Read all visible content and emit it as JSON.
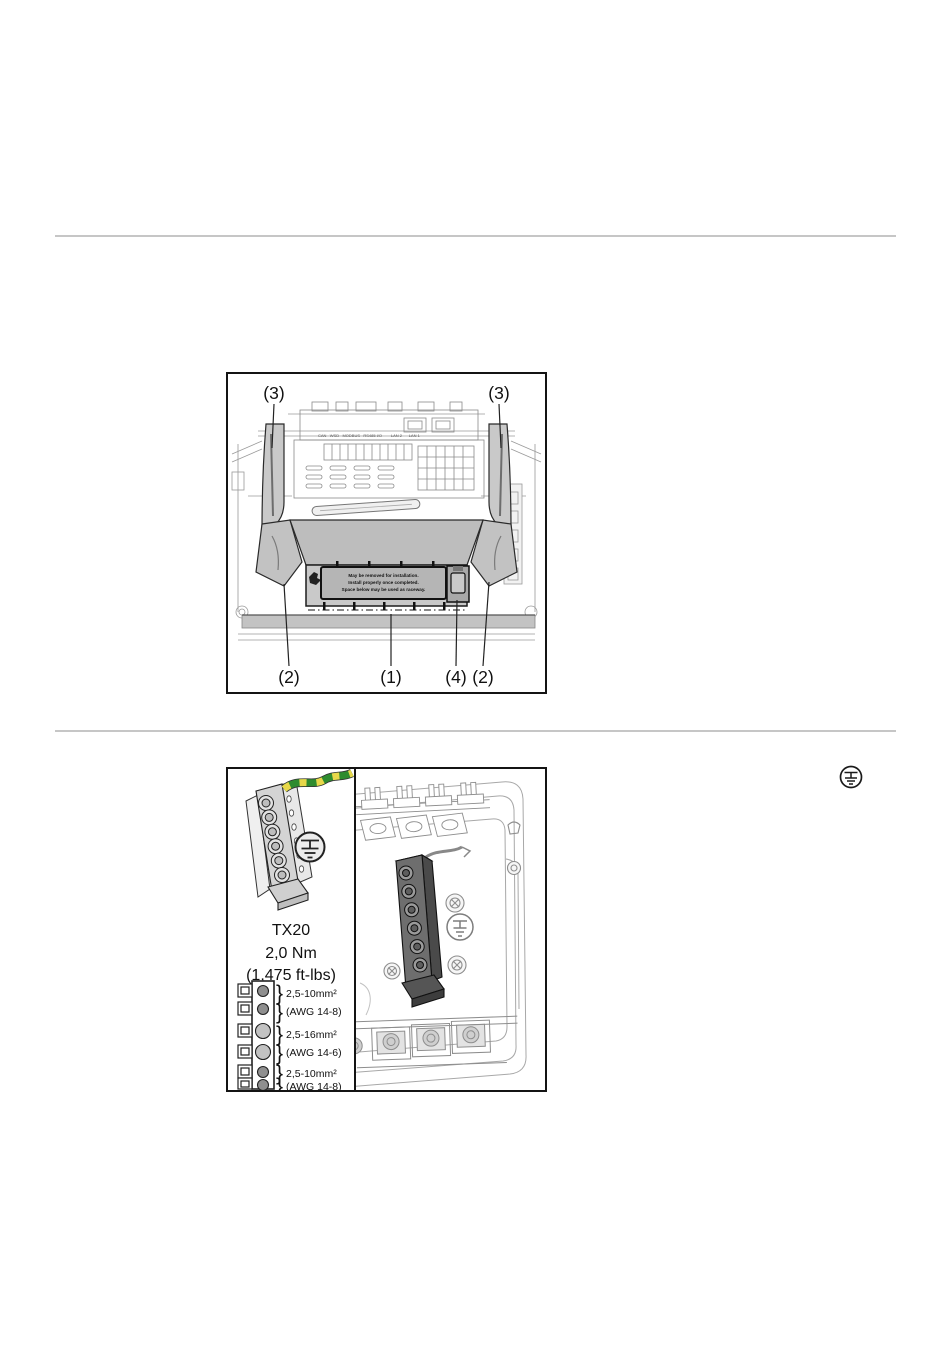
{
  "figure1": {
    "callout_top_left": "(3)",
    "callout_top_right": "(3)",
    "callout_bottom_1": "(2)",
    "callout_bottom_2": "(1)",
    "callout_bottom_3": "(4)",
    "callout_bottom_4": "(2)",
    "port_labels": "CAN   WSD   MODBUS   RS485 I/O        LAN 2      LAN 1",
    "cover_label": {
      "line1": "May be removed for installation.",
      "line2": "Install properly once completed.",
      "line3": "Space below may be used as raceway."
    }
  },
  "figure2": {
    "tool": "TX20",
    "torque_metric": "2,0 Nm",
    "torque_imperial": "(1,475 ft-lbs)",
    "brace": "}",
    "specs": [
      {
        "metric": "2,5-10mm²",
        "awg": "(AWG 14-8)"
      },
      {
        "metric": "2,5-16mm²",
        "awg": "(AWG 14-6)"
      },
      {
        "metric": "2,5-10mm²",
        "awg": "(AWG 14-8)"
      }
    ]
  },
  "icons": {
    "pe_symbol": "protective-earth"
  },
  "colors": {
    "cover_gray": "#c9c9c9",
    "label_gray": "#b5b5b5",
    "wire_green": "#2e8b2e",
    "wire_yellow": "#e8d84a",
    "divider_gray": "#c6c6c6"
  }
}
